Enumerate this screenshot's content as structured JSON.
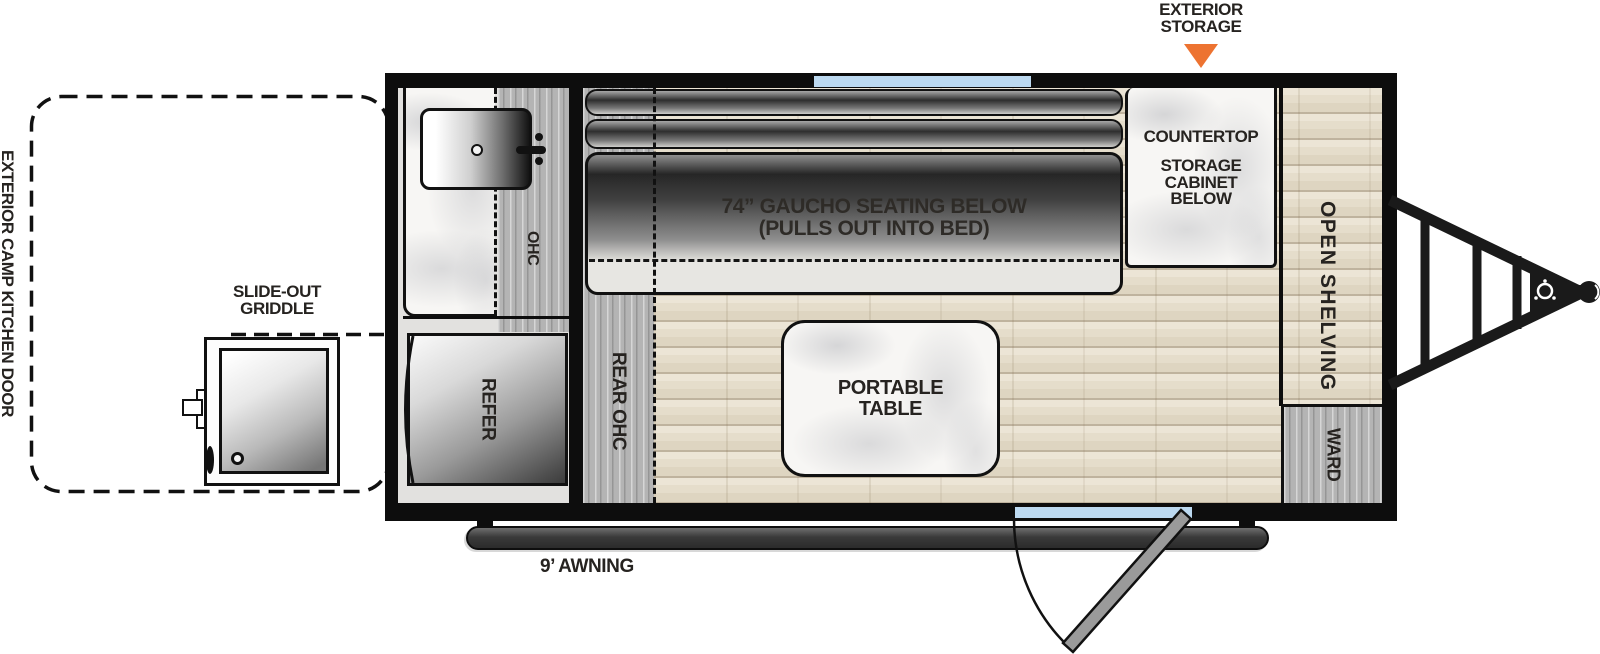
{
  "fp": {
    "labels": {
      "exterior_storage_1": "EXTERIOR",
      "exterior_storage_2": "STORAGE",
      "camp_kitchen_door": "EXTERIOR CAMP KITCHEN DOOR",
      "slide_out_griddle_1": "SLIDE-OUT",
      "slide_out_griddle_2": "GRIDDLE",
      "awning": "9’ AWNING",
      "ohc": "OHC",
      "rear_ohc": "REAR OHC",
      "refer": "REFER",
      "gaucho_1": "74” GAUCHO SEATING BELOW",
      "gaucho_2": "(PULLS OUT INTO BED)",
      "countertop": "COUNTERTOP",
      "storage_cabinet_1": "STORAGE",
      "storage_cabinet_2": "CABINET",
      "storage_cabinet_3": "BELOW",
      "open_shelving": "OPEN SHELVING",
      "ward": "WARD",
      "portable_table_1": "PORTABLE",
      "portable_table_2": "TABLE"
    },
    "colors": {
      "arrow_orange": "#ED7331",
      "window_blue": "#BCD9F0",
      "wall_black": "#0D0D0D"
    }
  }
}
